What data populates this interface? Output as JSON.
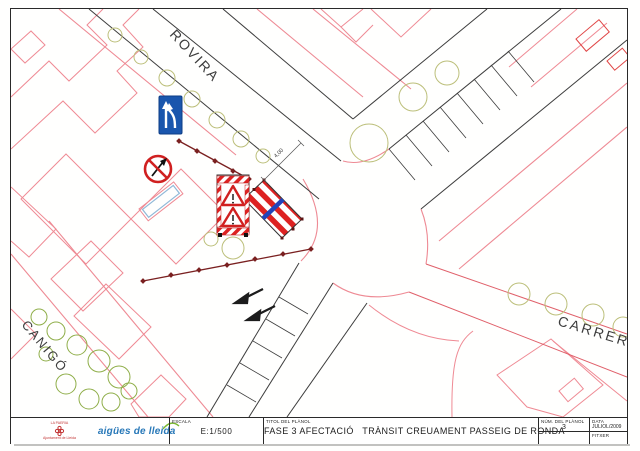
{
  "map": {
    "street_labels": {
      "rovira": "ROVIRA",
      "canigo": "CANIGÓ",
      "carrer": "CARRER"
    },
    "dimension": "4,00",
    "signs": {
      "merge": "lane-merge-sign",
      "prohibition": "no-entry-sign",
      "trailer": "warning-triangles-panel",
      "barrier": "striped-barrier",
      "arrows": "traffic-direction-arrows"
    },
    "colors": {
      "street_line": "#3c3c3c",
      "building_line": "#ef8a94",
      "carrer_line": "#e0606a",
      "tree_olive": "#bcbf7a",
      "tree_green": "#8fae49",
      "affect_line": "#7a2020",
      "sign_blue": "#1a56ad",
      "sign_red": "#d02020",
      "barrier_red": "#dd2222",
      "barrier_blue": "#2244bb"
    }
  },
  "title_block": {
    "escala_label": "ESCALA",
    "escala_value": "E:1/500",
    "titol_label": "TITOL DEL PLÀNOL",
    "titol_value": "FASE 3 AFECTACIÓ   TRÀNSIT CREUAMENT PASSEIG DE RONDA",
    "num_label": "NÚM. DEL PLÀNOL",
    "num_value": "3",
    "data_label": "DATA",
    "data_value": "JULIOL/2009",
    "fitxer_label": "FITXER"
  },
  "logos": {
    "paeria_top": "LA PAERIA",
    "paeria_bottom": "Ajuntament de Lleida",
    "aigues": "aigües de lleida"
  }
}
